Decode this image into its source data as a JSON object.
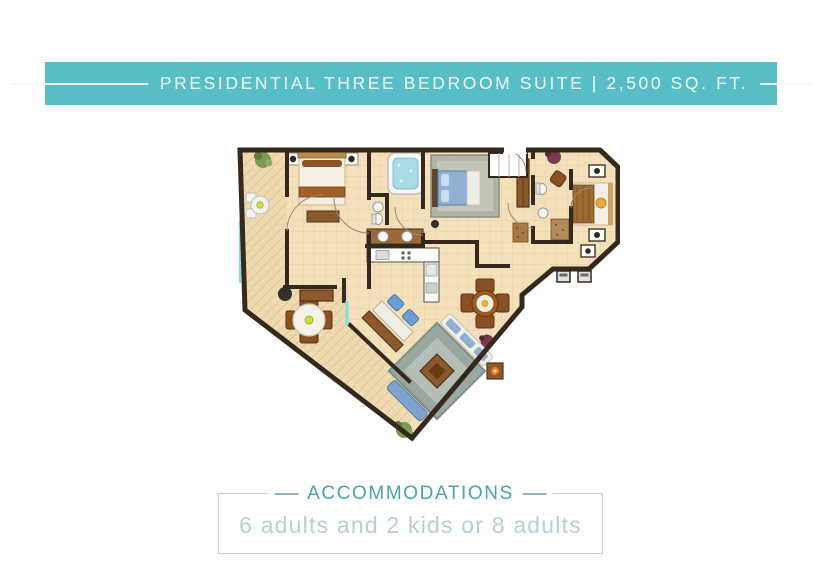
{
  "header": {
    "title": "PRESIDENTIAL THREE BEDROOM SUITE | 2,500 SQ. FT.",
    "background_color": "#57bdc6",
    "text_color": "#f2fbfc"
  },
  "floor_plan": {
    "kind": "hotel-suite-floor-plan",
    "wall_color": "#35291e",
    "floor_color": "#f4e0ba",
    "terrace_floor_color": "#efdbb2",
    "window_color": "#8fd8de",
    "wood_color": "#8a5a2e",
    "furniture_icons": [
      "bed-icon",
      "jacuzzi-tub-icon",
      "double-vanity-icon",
      "toilet-icon",
      "sink-icon",
      "kitchen-counter-icon",
      "wardrobe-icon",
      "closet-icon",
      "dining-table-icon",
      "patio-table-icon",
      "round-dining-table-icon",
      "sofa-icon",
      "area-rug-icon",
      "desk-icon",
      "bar-stool-icon",
      "plant-icon",
      "tv-console-icon",
      "nightstand-icon"
    ]
  },
  "accommodations": {
    "title": "ACCOMMODATIONS",
    "capacity": "6 adults and 2 kids or 8 adults",
    "title_color": "#4aa2ae",
    "text_color": "#b6cfd7",
    "border_color": "#bccfd4"
  }
}
